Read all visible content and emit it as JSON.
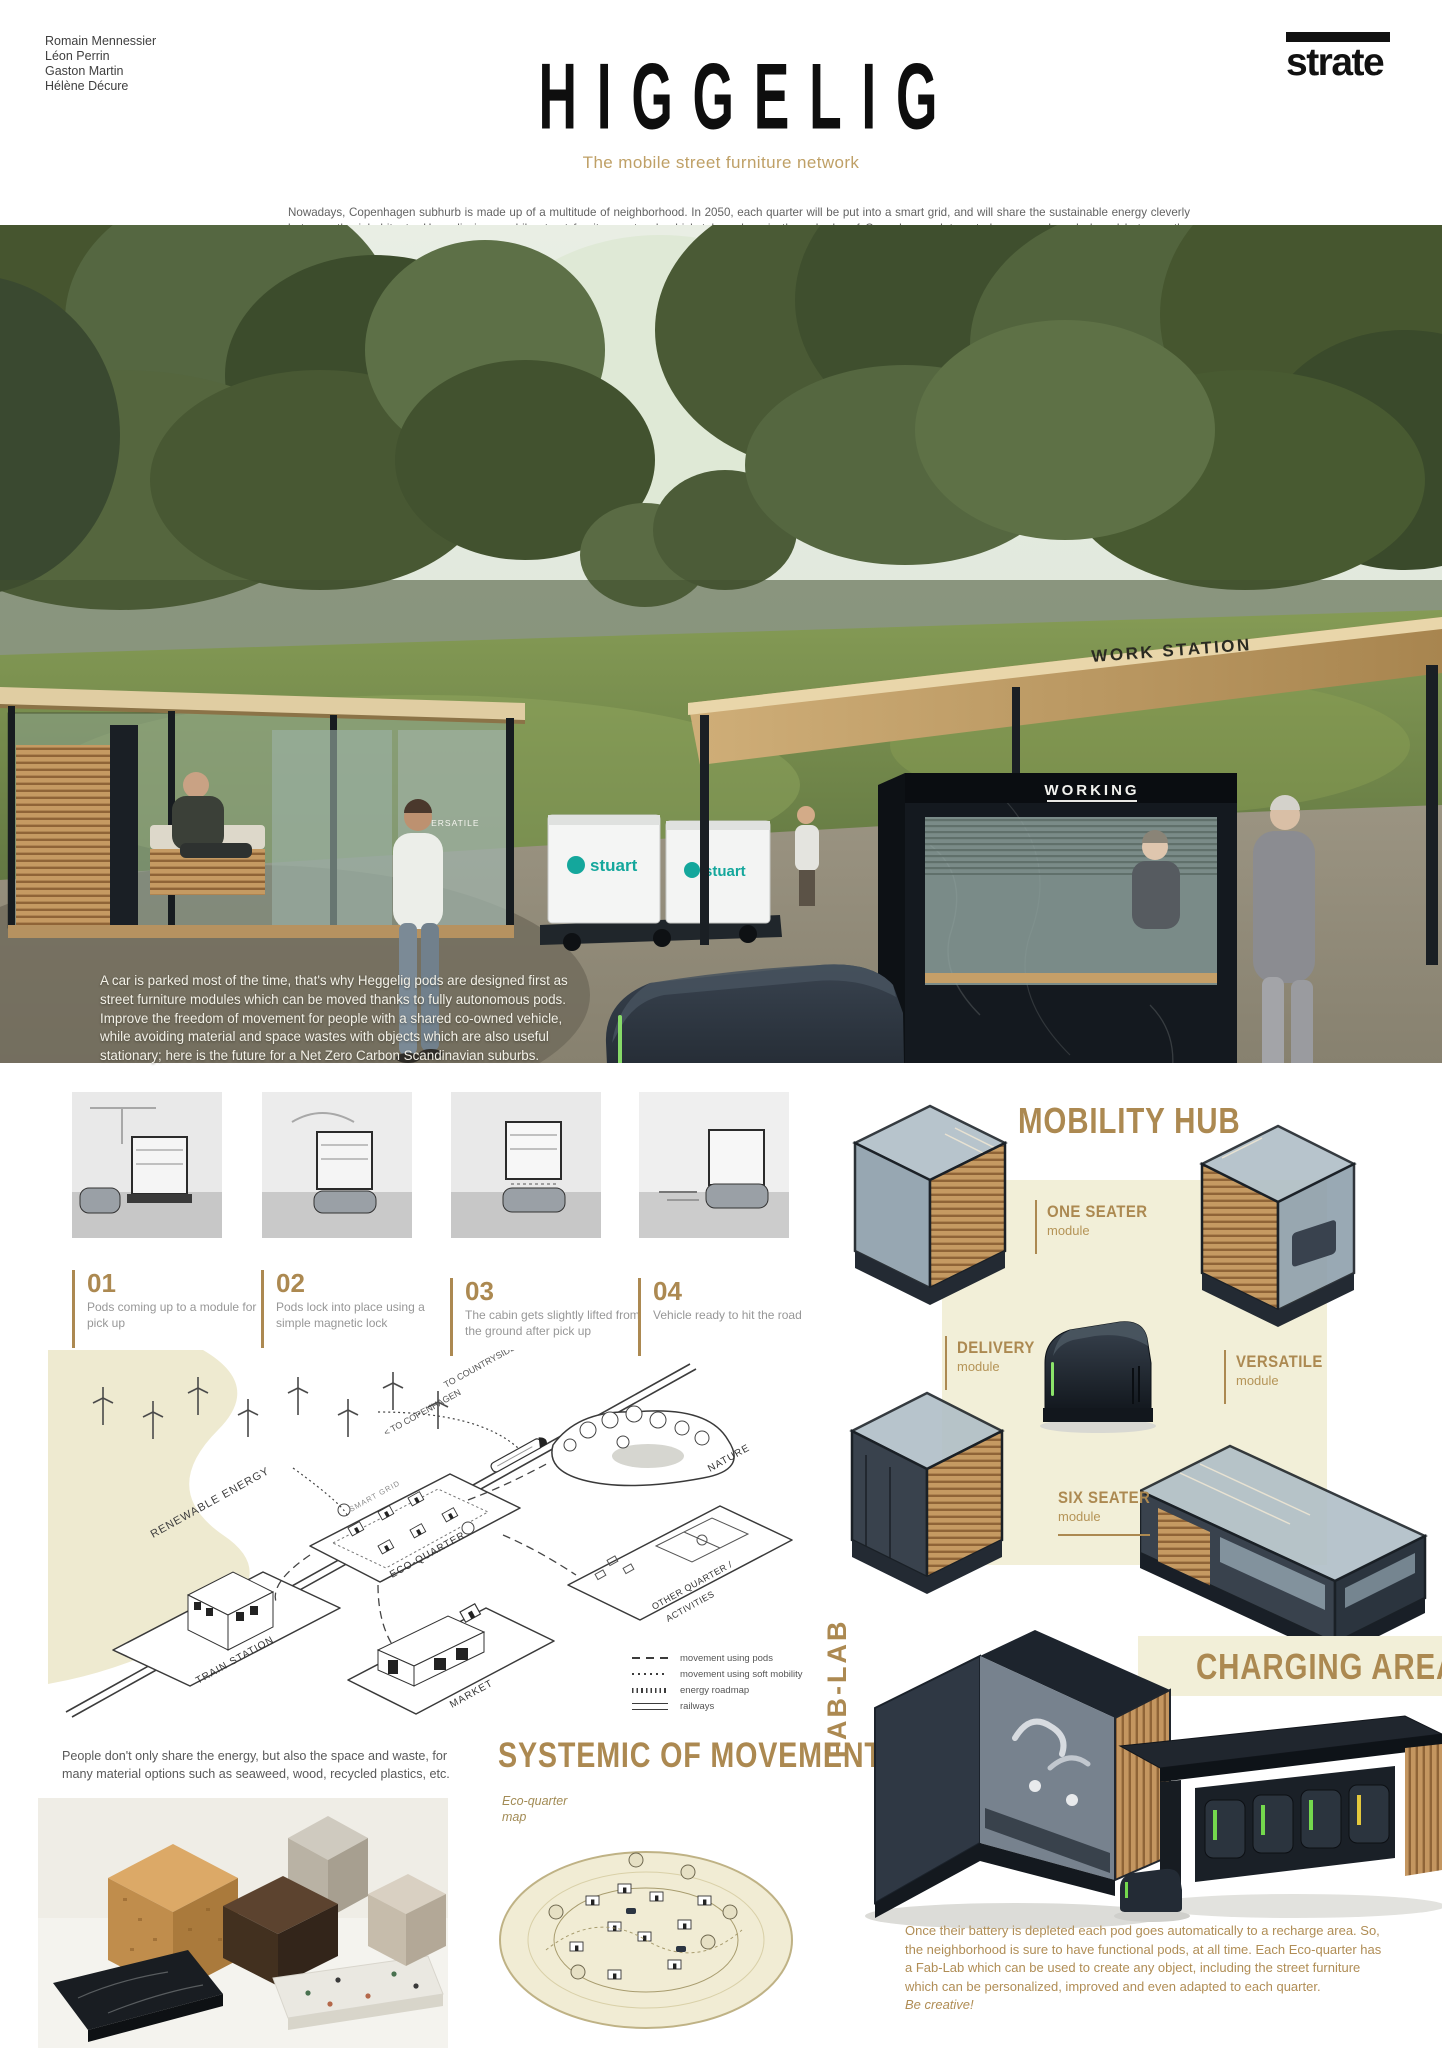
{
  "colors": {
    "accent_gold": "#ac8951",
    "subtitle_gold": "#bfa066",
    "cream_panel": "#f2efd8",
    "dark_navy": "#2c3542",
    "wood": "#c59a62",
    "stuart_teal": "#14a79c",
    "charge_green": "#74d84d"
  },
  "meta": {
    "authors": [
      "Romain Mennessier",
      "Léon Perrin",
      "Gaston Martin",
      "Hélène Décure"
    ],
    "logo": "strate"
  },
  "header": {
    "title": "HIGGELIG",
    "subtitle": "The mobile street furniture network",
    "intro": "Nowadays, Copenhagen subhurb is made up of a multitude of neighborhood. In 2050, each quarter will be put into a smart grid, and will share the sustainable energy cleverly between the inhabitants. Heggelig is a mobile street furniture network which takes place in the suburbs of Copenhagen. Integrated, co-owned, and shared between the residents of each eco-quarter, this concept guarantees the freedom of movement for people living outside of the city, who can't enjoy a dense public transport network but don't need large range vehicles neither."
  },
  "hero": {
    "caption": "A car is parked most of the time, that's why Heggelig pods are designed first as street furniture modules which can be moved thanks to fully autonomous pods. Improve the freedom of movement for people with a shared co-owned vehicle, while avoiding material and space wastes with objects which are also useful stationary; here is the future for a Net Zero Carbon Scandinavian suburbs.",
    "signs": {
      "work_station": "WORK STATION",
      "working": "WORKING",
      "versatile": "VERSATILE",
      "stuart": "stuart",
      "free": "FREE"
    }
  },
  "steps": [
    {
      "num": "01",
      "text": "Pods coming up to a module for pick up"
    },
    {
      "num": "02",
      "text": "Pods lock into place using a simple magnetic lock"
    },
    {
      "num": "03",
      "text": "The cabin gets slightly lifted from the ground after pick up"
    },
    {
      "num": "04",
      "text": "Vehicle ready to hit the road"
    }
  ],
  "diagram": {
    "title": "SYSTEMIC OF MOVEMENT",
    "map_label": "Eco-quarter map",
    "nodes": {
      "renewable_energy": "RENEWABLE ENERGY",
      "train_station": "TRAIN STATION",
      "eco_quarter": "ECO-QUARTER",
      "smart_grid": "SMART GRID",
      "nature": "NATURE",
      "other_quarter_line1": "OTHER QUARTER /",
      "other_quarter_line2": "ACTIVITIES",
      "market": "MARKET",
      "to_copenhagen": "< TO COPENHAGEN",
      "to_countryside": "TO COUNTRYSIDE >"
    },
    "legend": [
      {
        "label": "movement using pods"
      },
      {
        "label": "movement using soft mobility"
      },
      {
        "label": "energy roadmap"
      },
      {
        "label": "railways"
      }
    ]
  },
  "materials": {
    "caption": "People don't only share the energy, but also the space and waste, for many material options such as seaweed, wood, recycled plastics, etc."
  },
  "mobility": {
    "title": "MOBILITY HUB",
    "modules": [
      {
        "name": "ONE SEATER",
        "type": "module"
      },
      {
        "name": "DELIVERY",
        "type": "module"
      },
      {
        "name": "VERSATILE",
        "type": "module"
      },
      {
        "name": "SIX SEATER",
        "type": "module"
      }
    ]
  },
  "charging": {
    "fablab": "FAB-LAB",
    "title": "CHARGING AREA",
    "caption": "Once their battery is depleted each pod goes automatically to a recharge area. So, the neighborhood is sure to have functional pods, at all time. Each Eco-quarter has a Fab-Lab which can be used to create any object, including the street furniture which can be personalized, improved and even adapted to each quarter.",
    "caption_em": "Be creative!"
  }
}
